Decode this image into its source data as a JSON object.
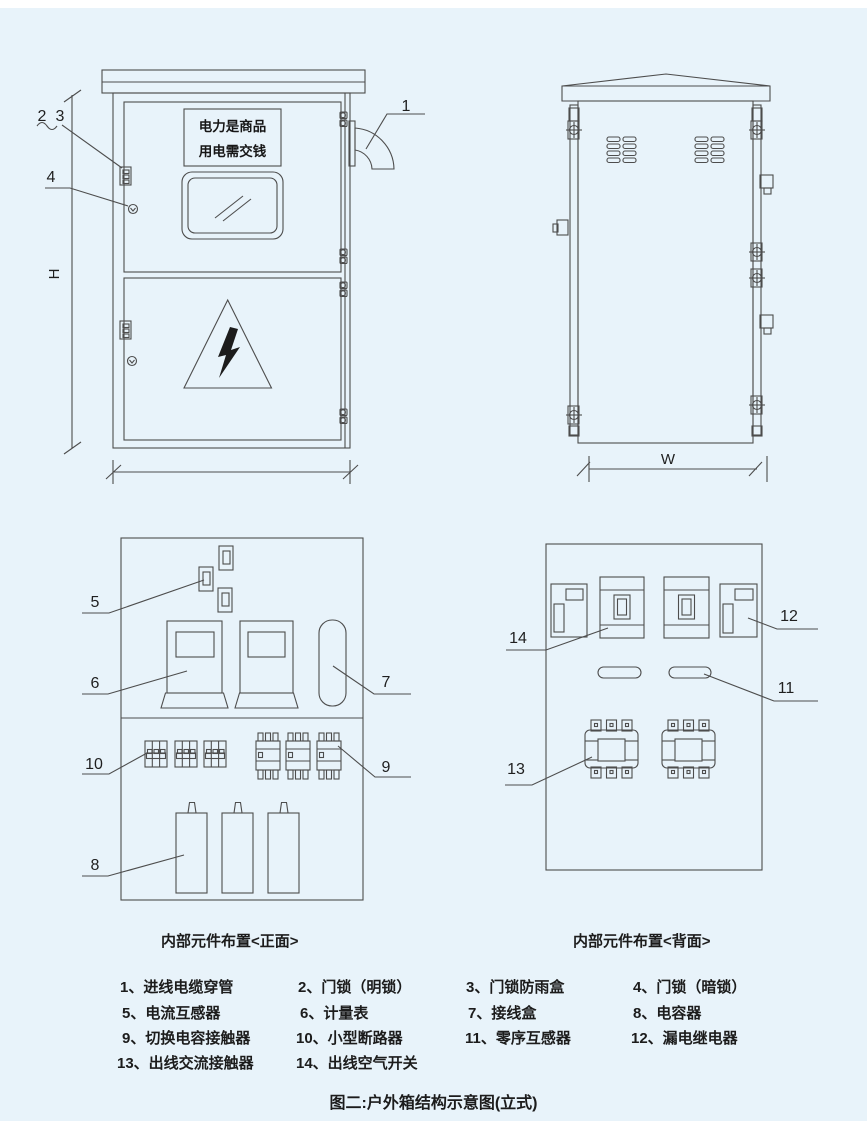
{
  "front_view": {
    "sign_line1": "电力是商品",
    "sign_line2": "用电需交钱",
    "callout_1": "1",
    "callout_2": "2",
    "callout_3": "3",
    "callout_4": "4",
    "height_label": "H"
  },
  "back_view": {
    "width_label": "W"
  },
  "internal_front": {
    "caption": "内部元件布置<正面>",
    "callout_5": "5",
    "callout_6": "6",
    "callout_7": "7",
    "callout_8": "8",
    "callout_9": "9",
    "callout_10": "10"
  },
  "internal_back": {
    "caption": "内部元件布置<背面>",
    "callout_11": "11",
    "callout_12": "12",
    "callout_13": "13",
    "callout_14": "14"
  },
  "legend": {
    "items": [
      {
        "label": "1、进线电缆穿管"
      },
      {
        "label": "2、门锁（明锁）"
      },
      {
        "label": "3、门锁防雨盒"
      },
      {
        "label": "4、门锁（暗锁）"
      },
      {
        "label": "5、电流互感器"
      },
      {
        "label": "6、计量表"
      },
      {
        "label": "7、接线盒"
      },
      {
        "label": "8、电容器"
      },
      {
        "label": "9、切换电容接触器"
      },
      {
        "label": "10、小型断路器"
      },
      {
        "label": "11、零序互感器"
      },
      {
        "label": "12、漏电继电器"
      },
      {
        "label": "13、出线交流接触器"
      },
      {
        "label": "14、出线空气开关"
      }
    ]
  },
  "figure_caption": "图二:户外箱结构示意图(立式)",
  "colors": {
    "background": "#e8f3fa",
    "line": "#4d4d4d",
    "text": "#1f1f1f"
  }
}
